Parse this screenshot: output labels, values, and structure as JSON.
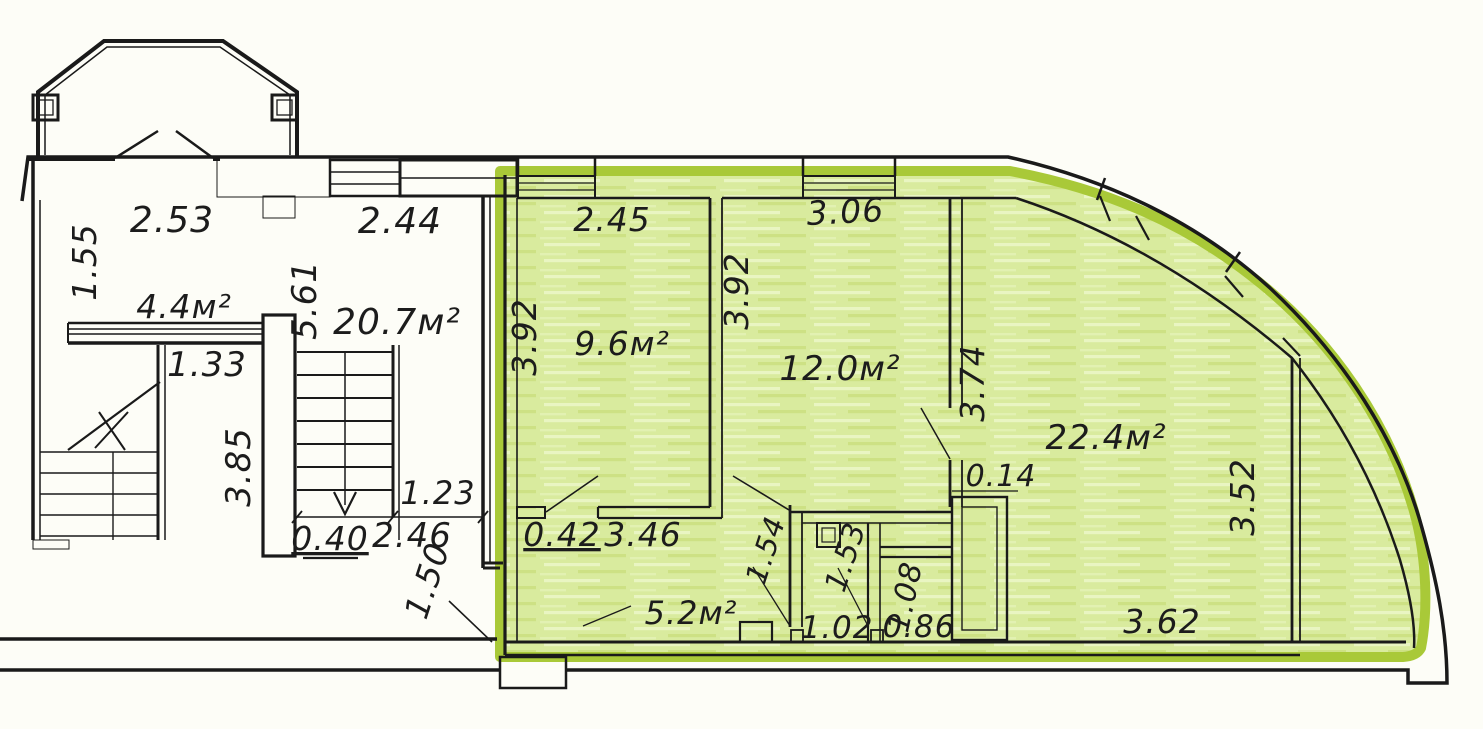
{
  "floor_plan": {
    "kind": "architectural-floor-plan",
    "units": "meters",
    "colors": {
      "highlight_border": "#a9c938",
      "highlight_fill": "#d9eb9e",
      "linework": "#1a1a1a",
      "paper": "#fdfdf7",
      "label_ink": "#1c1c1c"
    },
    "areas_summary": {
      "left_wing_rooms": [
        "4.4м²",
        "20.7м²"
      ],
      "highlighted_unit_rooms": [
        "9.6м²",
        "12.0м²",
        "22.4м²",
        "5.2м²"
      ]
    },
    "labels": [
      {
        "id": "dim-2-53",
        "text": "2.53",
        "x": 172,
        "y": 232,
        "rot": 0,
        "size": 36
      },
      {
        "id": "dim-1-55",
        "text": "1.55",
        "x": 96,
        "y": 262,
        "rot": -90,
        "size": 33
      },
      {
        "id": "area-4-4",
        "text": "4.4м²",
        "x": 184,
        "y": 318,
        "rot": 0,
        "size": 33
      },
      {
        "id": "dim-5-61",
        "text": "5.61",
        "x": 316,
        "y": 300,
        "rot": -90,
        "size": 34
      },
      {
        "id": "area-20-7",
        "text": "20.7м²",
        "x": 397,
        "y": 334,
        "rot": 0,
        "size": 36
      },
      {
        "id": "dim-2-44",
        "text": "2.44",
        "x": 400,
        "y": 233,
        "rot": 0,
        "size": 36
      },
      {
        "id": "dim-1-33",
        "text": "1.33",
        "x": 207,
        "y": 376,
        "rot": 0,
        "size": 34
      },
      {
        "id": "dim-3-85",
        "text": "3.85",
        "x": 250,
        "y": 467,
        "rot": -90,
        "size": 34
      },
      {
        "id": "dim-1-23",
        "text": "1.23",
        "x": 438,
        "y": 504,
        "rot": 0,
        "size": 32
      },
      {
        "id": "dim-2-46",
        "text": "2.46",
        "x": 412,
        "y": 547,
        "rot": 0,
        "size": 34
      },
      {
        "id": "dim-0-40",
        "text": "0.40",
        "x": 330,
        "y": 550,
        "rot": 0,
        "size": 33,
        "underline": true
      },
      {
        "id": "dim-1-50",
        "text": "1.50",
        "x": 438,
        "y": 584,
        "rot": -72,
        "size": 33
      },
      {
        "id": "dim-2-45",
        "text": "2.45",
        "x": 612,
        "y": 231,
        "rot": 0,
        "size": 33
      },
      {
        "id": "dim-3-92-left",
        "text": "3.92",
        "x": 536,
        "y": 337,
        "rot": -90,
        "size": 33
      },
      {
        "id": "area-9-6",
        "text": "9.6м²",
        "x": 622,
        "y": 355,
        "rot": 0,
        "size": 33
      },
      {
        "id": "dim-3-92-mid",
        "text": "3.92",
        "x": 748,
        "y": 291,
        "rot": -90,
        "size": 33
      },
      {
        "id": "dim-3-06",
        "text": "3.06",
        "x": 846,
        "y": 223,
        "rot": -3,
        "size": 33
      },
      {
        "id": "area-12-0",
        "text": "12.0м²",
        "x": 840,
        "y": 380,
        "rot": 0,
        "size": 34
      },
      {
        "id": "dim-3-74",
        "text": "3.74",
        "x": 984,
        "y": 383,
        "rot": -90,
        "size": 33
      },
      {
        "id": "dim-0-14",
        "text": "0.14",
        "x": 1001,
        "y": 486,
        "rot": 0,
        "size": 30
      },
      {
        "id": "area-22-4",
        "text": "22.4м²",
        "x": 1106,
        "y": 449,
        "rot": 0,
        "size": 34
      },
      {
        "id": "dim-3-52",
        "text": "3.52",
        "x": 1254,
        "y": 497,
        "rot": -90,
        "size": 33
      },
      {
        "id": "dim-0-42",
        "text": "0.42",
        "x": 562,
        "y": 546,
        "rot": 0,
        "size": 33,
        "underline": true
      },
      {
        "id": "dim-3-46",
        "text": "3.46",
        "x": 643,
        "y": 546,
        "rot": 0,
        "size": 33
      },
      {
        "id": "area-5-2",
        "text": "5.2м²",
        "x": 691,
        "y": 624,
        "rot": 0,
        "size": 32
      },
      {
        "id": "dim-1-54",
        "text": "1.54",
        "x": 775,
        "y": 553,
        "rot": -72,
        "size": 29
      },
      {
        "id": "dim-1-53",
        "text": "1.53",
        "x": 855,
        "y": 560,
        "rot": -72,
        "size": 30
      },
      {
        "id": "dim-1-08",
        "text": "1.08",
        "x": 915,
        "y": 599,
        "rot": -78,
        "size": 30
      },
      {
        "id": "dim-1-02",
        "text": "1.02",
        "x": 837,
        "y": 638,
        "rot": 0,
        "size": 31
      },
      {
        "id": "dim-0-86",
        "text": "0.86",
        "x": 919,
        "y": 637,
        "rot": 0,
        "size": 31
      },
      {
        "id": "dim-3-62",
        "text": "3.62",
        "x": 1162,
        "y": 633,
        "rot": 0,
        "size": 33
      }
    ]
  }
}
